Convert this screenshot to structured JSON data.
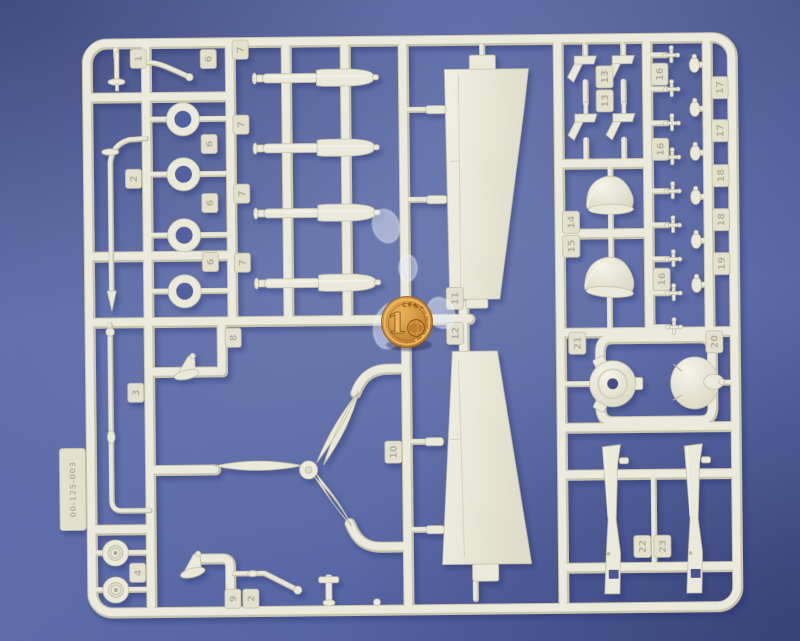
{
  "scene": {
    "subject": "Cream plastic model kit sprue with aircraft parts on blue paper, 1 euro cent coin for scale",
    "sprue_code": "00-125-003",
    "background_hex": "#5766a4",
    "plastic_hex": "#eae8d8",
    "coin_hex": "#c8852f"
  },
  "coin": {
    "digit": "1",
    "word": "CENT"
  },
  "part_tags": [
    "1",
    "2",
    "3",
    "4",
    "6",
    "6",
    "6",
    "6",
    "7",
    "7",
    "7",
    "7",
    "8",
    "9",
    "2",
    "10",
    "11",
    "12",
    "13",
    "13",
    "14",
    "15",
    "16",
    "16",
    "16",
    "17",
    "17",
    "18",
    "18",
    "19",
    "21",
    "20",
    "22",
    "23"
  ]
}
